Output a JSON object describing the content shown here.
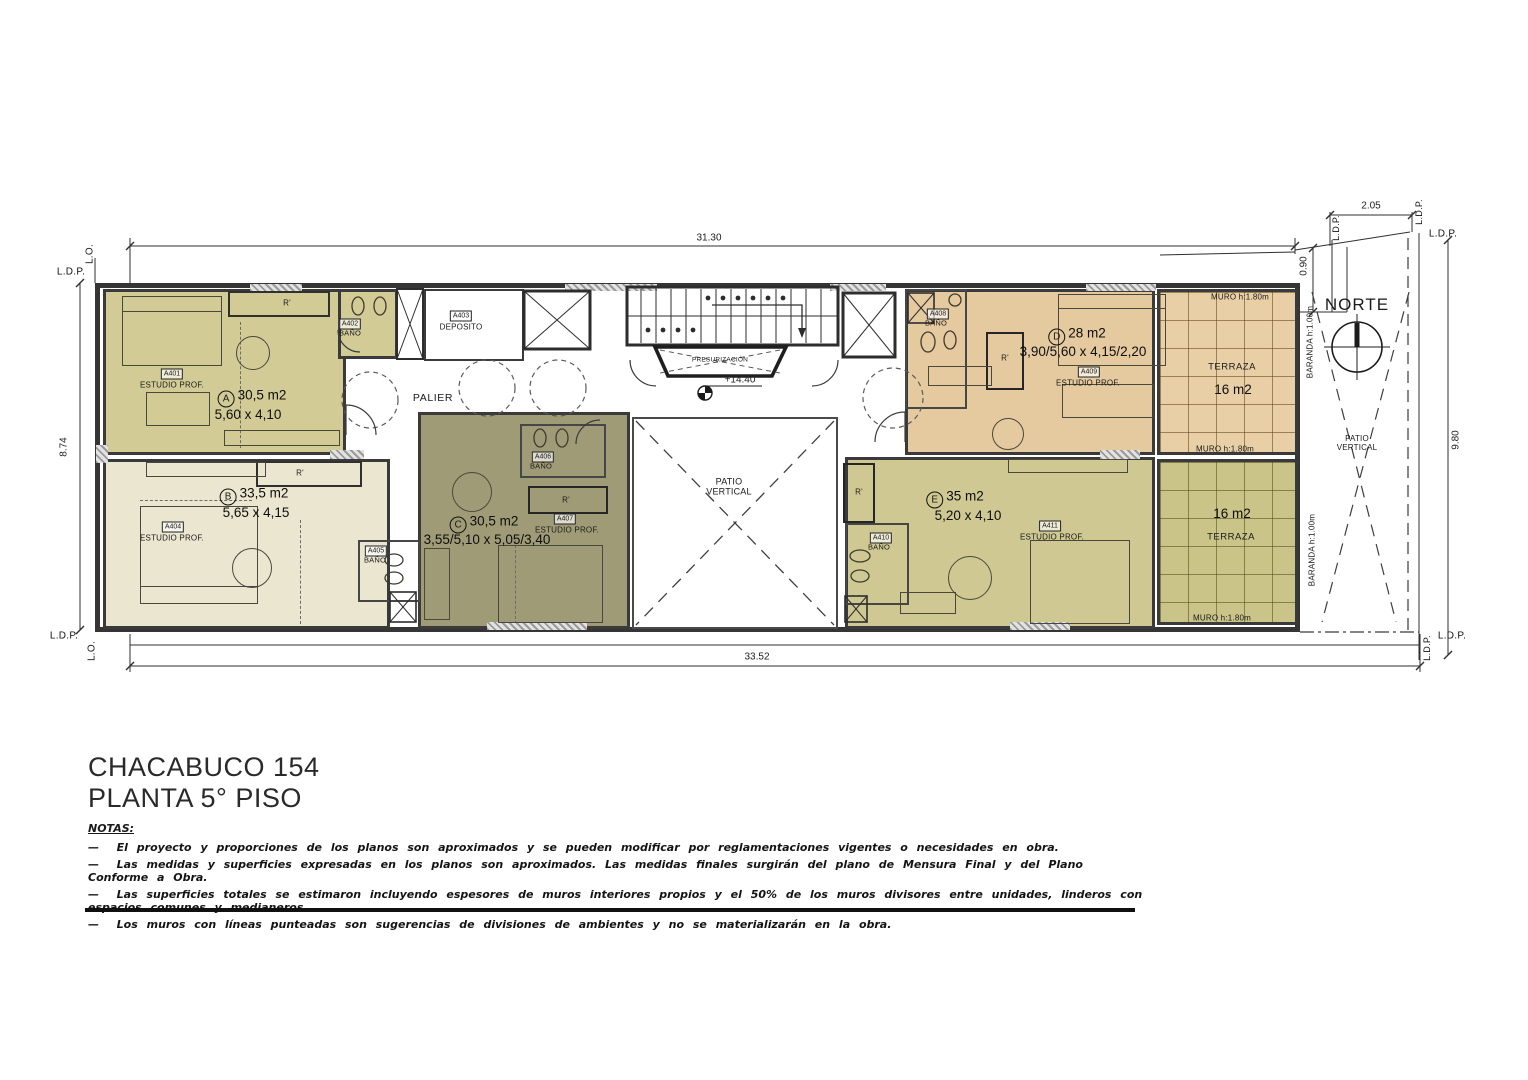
{
  "title_block": {
    "address": "CHACABUCO 154",
    "floor": "PLANTA 5° PISO"
  },
  "notes": {
    "heading": "NOTAS:",
    "bullet": "—",
    "items": [
      "El proyecto y proporciones de los planos son aproximados y se pueden modificar por reglamentaciones vigentes o necesidades en obra.",
      "Las medidas y superficies expresadas en los planos son aproximados. Las medidas finales surgirán del plano de Mensura Final y del Plano Conforme a Obra.",
      "Las superficies totales se estimaron incluyendo espesores de muros interiores propios y el 50% de los muros divisores entre unidades, linderos con espacios comunes y medianeros.",
      "Los muros con líneas punteadas son sugerencias de divisiones de ambientes y no se materializarán en la obra."
    ]
  },
  "dimensions": {
    "top_width": "31.30",
    "bottom_width": "33.52",
    "left_height": "8.74",
    "right_height": "9.80",
    "setback": "0.90",
    "notch_width": "2.05"
  },
  "boundaries": {
    "ldp": "L.D.P.",
    "lo": "L.O."
  },
  "compass": {
    "label": "NORTE"
  },
  "level_marker": "+14.40",
  "common_areas": {
    "palier": "PALIER",
    "deposito_tag": "A403",
    "deposito_label": "DEPOSITO",
    "stair_lobby": "PRESURIZACIÓN",
    "patio_label": "PATIO VERTICAL",
    "closet_label": "R'"
  },
  "units": [
    {
      "letter": "A",
      "area": "30,5 m2",
      "dims": "5,60 x 4,10",
      "tag": "A401",
      "room_label": "ESTUDIO PROF.",
      "bath_tag": "A402",
      "bath_label": "BAÑO"
    },
    {
      "letter": "B",
      "area": "33,5 m2",
      "dims": "5,65 x 4,15",
      "tag": "A404",
      "room_label": "ESTUDIO PROF.",
      "bath_tag": "A405",
      "bath_label": "BAÑO"
    },
    {
      "letter": "C",
      "area": "30,5 m2",
      "dims": "3,55/5,10 x 5,05/3,40",
      "tag": "A407",
      "room_label": "ESTUDIO PROF.",
      "bath_tag": "A406",
      "bath_label": "BAÑO"
    },
    {
      "letter": "D",
      "area": "28 m2",
      "dims": "3,90/5,60 x 4,15/2,20",
      "tag": "A409",
      "room_label": "ESTUDIO PROF.",
      "bath_tag": "A408",
      "bath_label": "BAÑO"
    },
    {
      "letter": "E",
      "area": "35 m2",
      "dims": "5,20 x 4,10",
      "tag": "A411",
      "room_label": "ESTUDIO PROF.",
      "bath_tag": "A410",
      "bath_label": "BAÑO"
    }
  ],
  "terraces": {
    "top": {
      "label": "TERRAZA",
      "area": "16 m2"
    },
    "bottom": {
      "label": "TERRAZA",
      "area": "16 m2"
    },
    "muro_label": "MURO  h:1.80m",
    "baranda_label": "BARANDA  h:1.00m"
  },
  "colors": {
    "unit_a": "#d2cb96",
    "unit_b": "#eae6d0",
    "unit_c": "#a09b77",
    "unit_d": "#e5c99f",
    "unit_e": "#cfc892",
    "terrace_top": "#e9cfa6",
    "terrace_bottom": "#cbc489",
    "wall": "#3a3a3a"
  }
}
